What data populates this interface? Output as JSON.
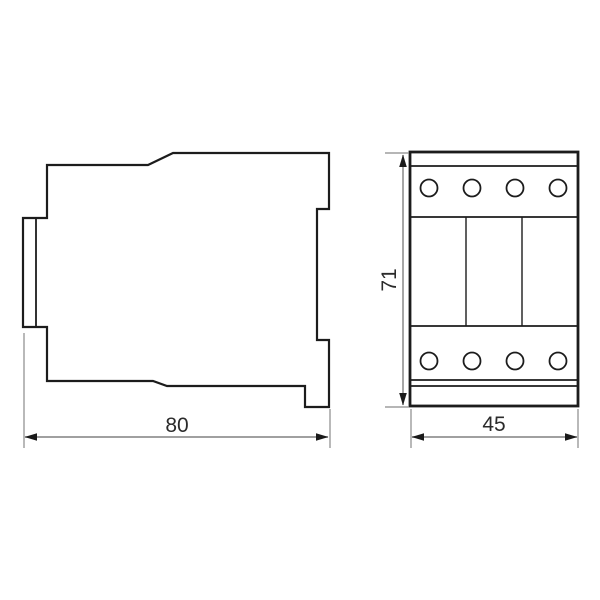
{
  "title": "Contactor outline dimension drawing",
  "views": {
    "side": {
      "name": "side-view",
      "dimension": {
        "label": "80",
        "orientation": "horizontal",
        "position": "bottom"
      }
    },
    "front": {
      "name": "front-view",
      "height_dimension": {
        "label": "71",
        "orientation": "vertical",
        "position": "left"
      },
      "width_dimension": {
        "label": "45",
        "orientation": "horizontal",
        "position": "bottom"
      },
      "terminal_rows": 2,
      "terminals_per_row": 4,
      "pole_sections": 3
    }
  },
  "colors": {
    "background": "#ffffff",
    "outline": "#1c1c1c",
    "dimension_line": "#808080",
    "dimension_text": "#2b2b2b",
    "arrowhead": "#1a1a1a"
  }
}
